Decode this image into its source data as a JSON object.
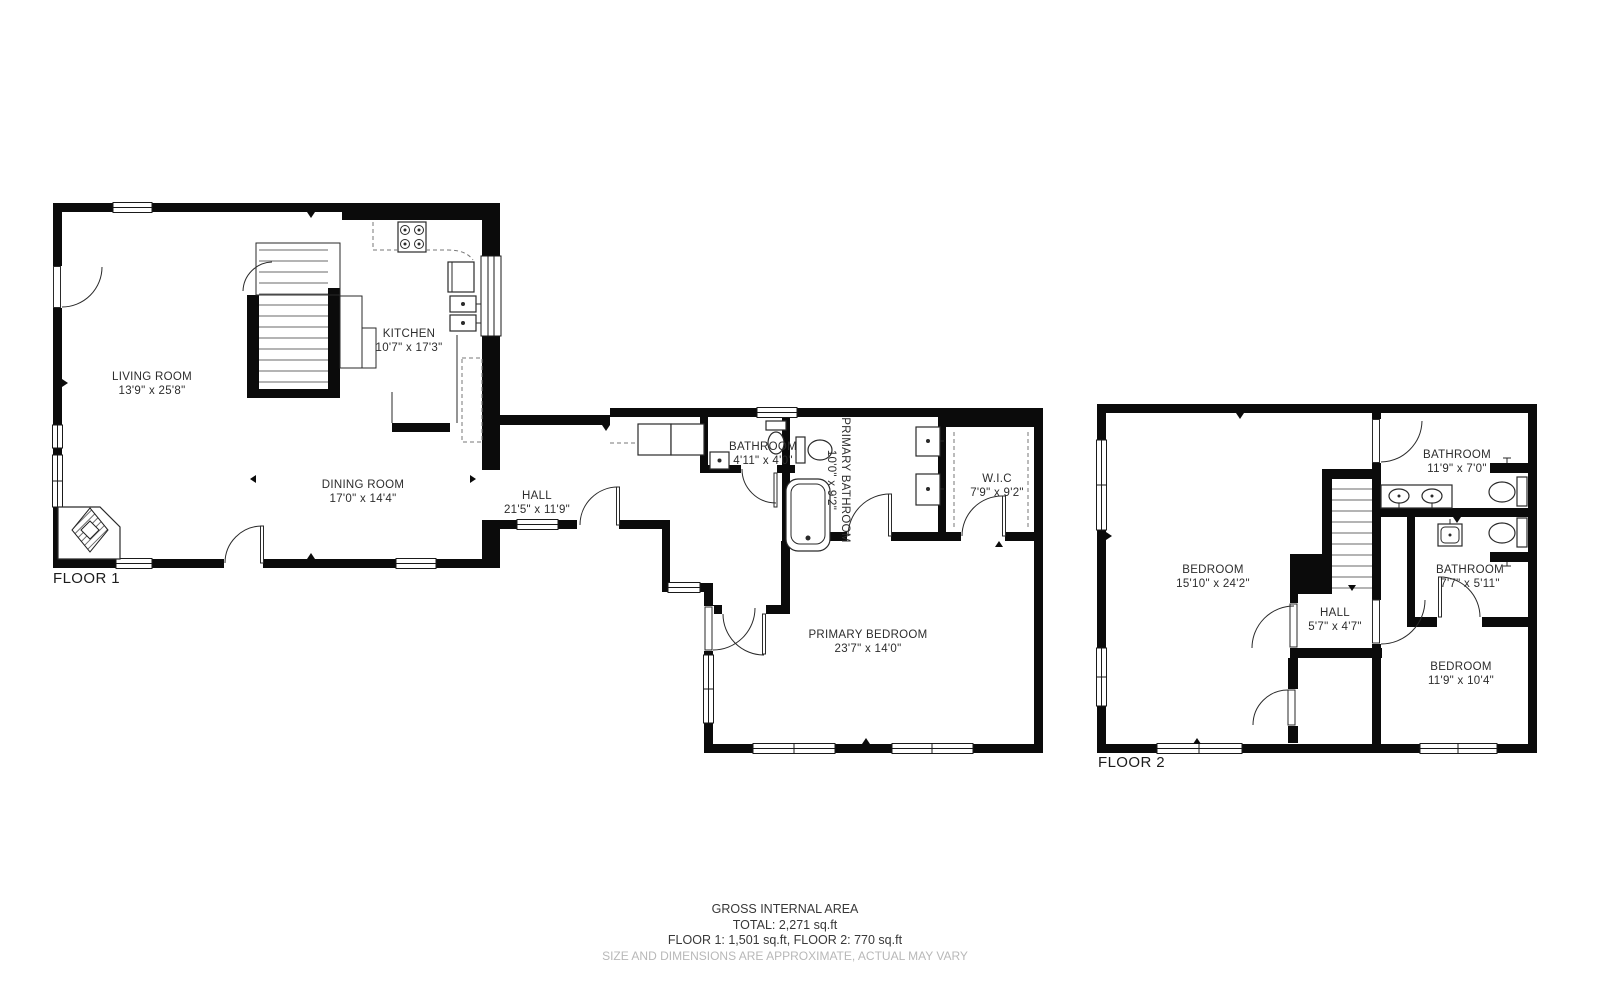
{
  "floor1": {
    "label": "FLOOR 1",
    "rooms": {
      "living": {
        "name": "LIVING ROOM",
        "dims": "13'9\" x 25'8\""
      },
      "kitchen": {
        "name": "KITCHEN",
        "dims": "10'7\" x 17'3\""
      },
      "dining": {
        "name": "DINING ROOM",
        "dims": "17'0\" x 14'4\""
      },
      "hall": {
        "name": "HALL",
        "dims": "21'5\" x 11'9\""
      },
      "bathroom": {
        "name": "BATHROOM",
        "dims": "4'11\" x 4'0\""
      },
      "primary_bathroom": {
        "name": "PRIMARY BATHROOM",
        "dims": "10'0\" x 9'2\""
      },
      "wic": {
        "name": "W.I.C",
        "dims": "7'9\" x 9'2\""
      },
      "primary_bedroom": {
        "name": "PRIMARY BEDROOM",
        "dims": "23'7\" x 14'0\""
      }
    }
  },
  "floor2": {
    "label": "FLOOR 2",
    "rooms": {
      "bedroom_left": {
        "name": "BEDROOM",
        "dims": "15'10\" x 24'2\""
      },
      "bathroom_top": {
        "name": "BATHROOM",
        "dims": "11'9\" x 7'0\""
      },
      "hall": {
        "name": "HALL",
        "dims": "5'7\" x 4'7\""
      },
      "bathroom_mid": {
        "name": "BATHROOM",
        "dims": "7'7\" x 5'11\""
      },
      "bedroom_bottom": {
        "name": "BEDROOM",
        "dims": "11'9\" x 10'4\""
      }
    }
  },
  "footer": {
    "title": "GROSS INTERNAL AREA",
    "total": "TOTAL: 2,271 sq.ft",
    "floors": "FLOOR 1: 1,501 sq.ft, FLOOR 2: 770 sq.ft",
    "disclaimer": "SIZE AND DIMENSIONS ARE APPROXIMATE, ACTUAL MAY VARY"
  },
  "colors": {
    "wall": "#0b0b0b",
    "text": "#2d2d2d",
    "muted": "#b8b8b8",
    "background": "#ffffff"
  }
}
